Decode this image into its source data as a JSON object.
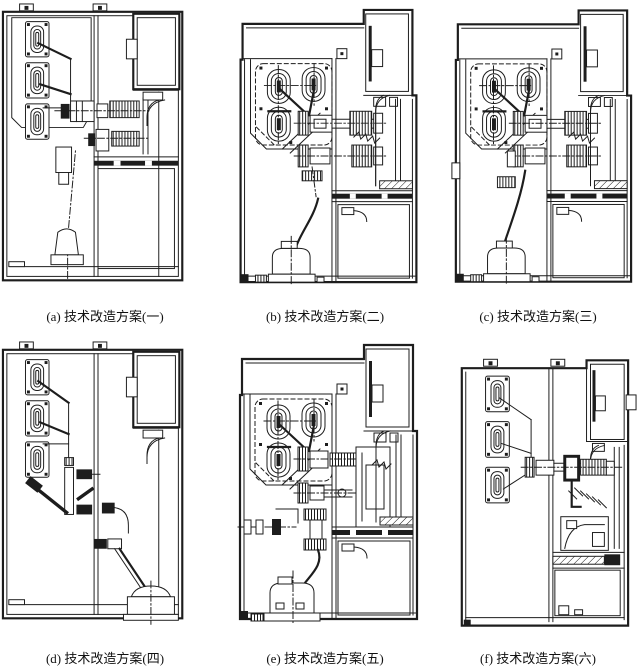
{
  "colors": {
    "ink": "#1d1d1d",
    "background": "#ffffff"
  },
  "panels": [
    {
      "label": "a",
      "caption": "(a) 技术改造方案(一)"
    },
    {
      "label": "b",
      "caption": "(b) 技术改造方案(二)"
    },
    {
      "label": "c",
      "caption": "(c) 技术改造方案(三)"
    },
    {
      "label": "d",
      "caption": "(d) 技术改造方案(四)"
    },
    {
      "label": "e",
      "caption": "(e) 技术改造方案(五)"
    },
    {
      "label": "f",
      "caption": "(f) 技术改造方案(六)"
    }
  ]
}
